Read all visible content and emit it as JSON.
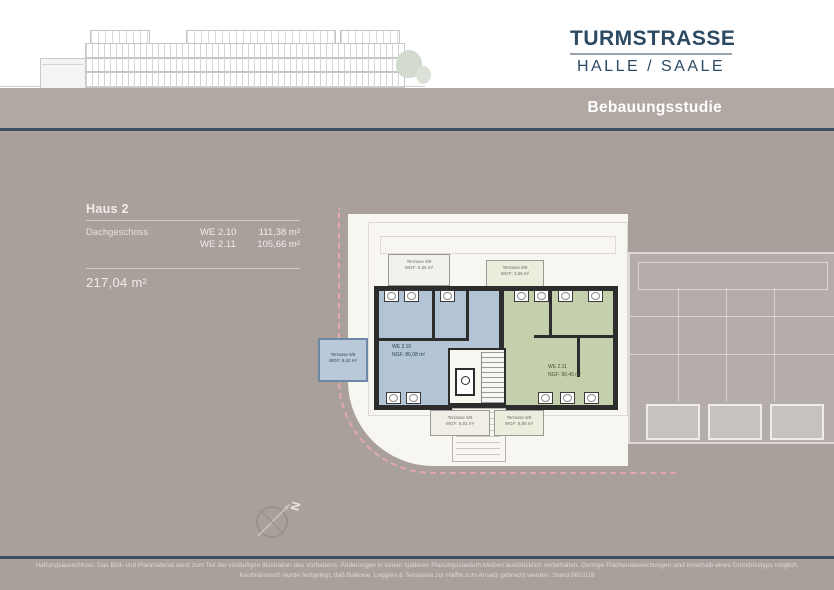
{
  "brand": {
    "title": "TURMSTRASSE",
    "subtitle": "HALLE / SAALE"
  },
  "header": {
    "label": "Bebauungsstudie"
  },
  "info_panel": {
    "house": "Haus 2",
    "floor": "Dachgeschoss",
    "units": [
      {
        "id": "WE 2.10",
        "area": "111,38 m²"
      },
      {
        "id": "WE 2.11",
        "area": "105,66 m²"
      }
    ],
    "total_area": "217,04 m²"
  },
  "plan": {
    "apartments": [
      {
        "id": "WE 2.10",
        "ngf": "NGF: 86,08 m²"
      },
      {
        "id": "WE 2.11",
        "ngf": "NGF: 90,46 m²"
      }
    ],
    "terraces": [
      {
        "name": "Terrasse 9/9",
        "wgf": "WGF: 5,36 m²"
      },
      {
        "name": "Terrasse 9/9",
        "wgf": "WGF: 3,85 m²"
      },
      {
        "name": "Terrasse 9/9",
        "wgf": "WGF: 9,42 m²"
      },
      {
        "name": "Terrasse 9/9",
        "wgf": "WGF: 6,81 m²"
      },
      {
        "name": "Terrasse 9/9",
        "wgf": "WGF: 8,85 m²"
      }
    ],
    "compass_label": "N"
  },
  "footer": {
    "line1": "Haftungsausschluss: Das Bild- und Planmaterial dient zum Teil der vorläufigen Illustration des Vorhabens. Änderungen in einem späteren Planungsstadium bleiben ausdrücklich vorbehalten. Geringe Flächenabweichungen sind innerhalb eines Grundrisstyps möglich.",
    "line2": "Kaufmännisch wurde festgelegt, daß Balkone, Loggien & Terrassen zur Hälfte zum Ansatz gebracht werden. Stand 08/2018"
  },
  "colors": {
    "background": "#a9a09c",
    "header_bar": "#b1a8a4",
    "navy_line": "#3c4f60",
    "title_navy": "#2d4a63",
    "plate": "#f8f6f1",
    "wall": "#2d2d2d",
    "apartment_blue": "#b3c4d6",
    "apartment_green": "#c4cfab",
    "boundary_pink": "#e3a7b0"
  }
}
